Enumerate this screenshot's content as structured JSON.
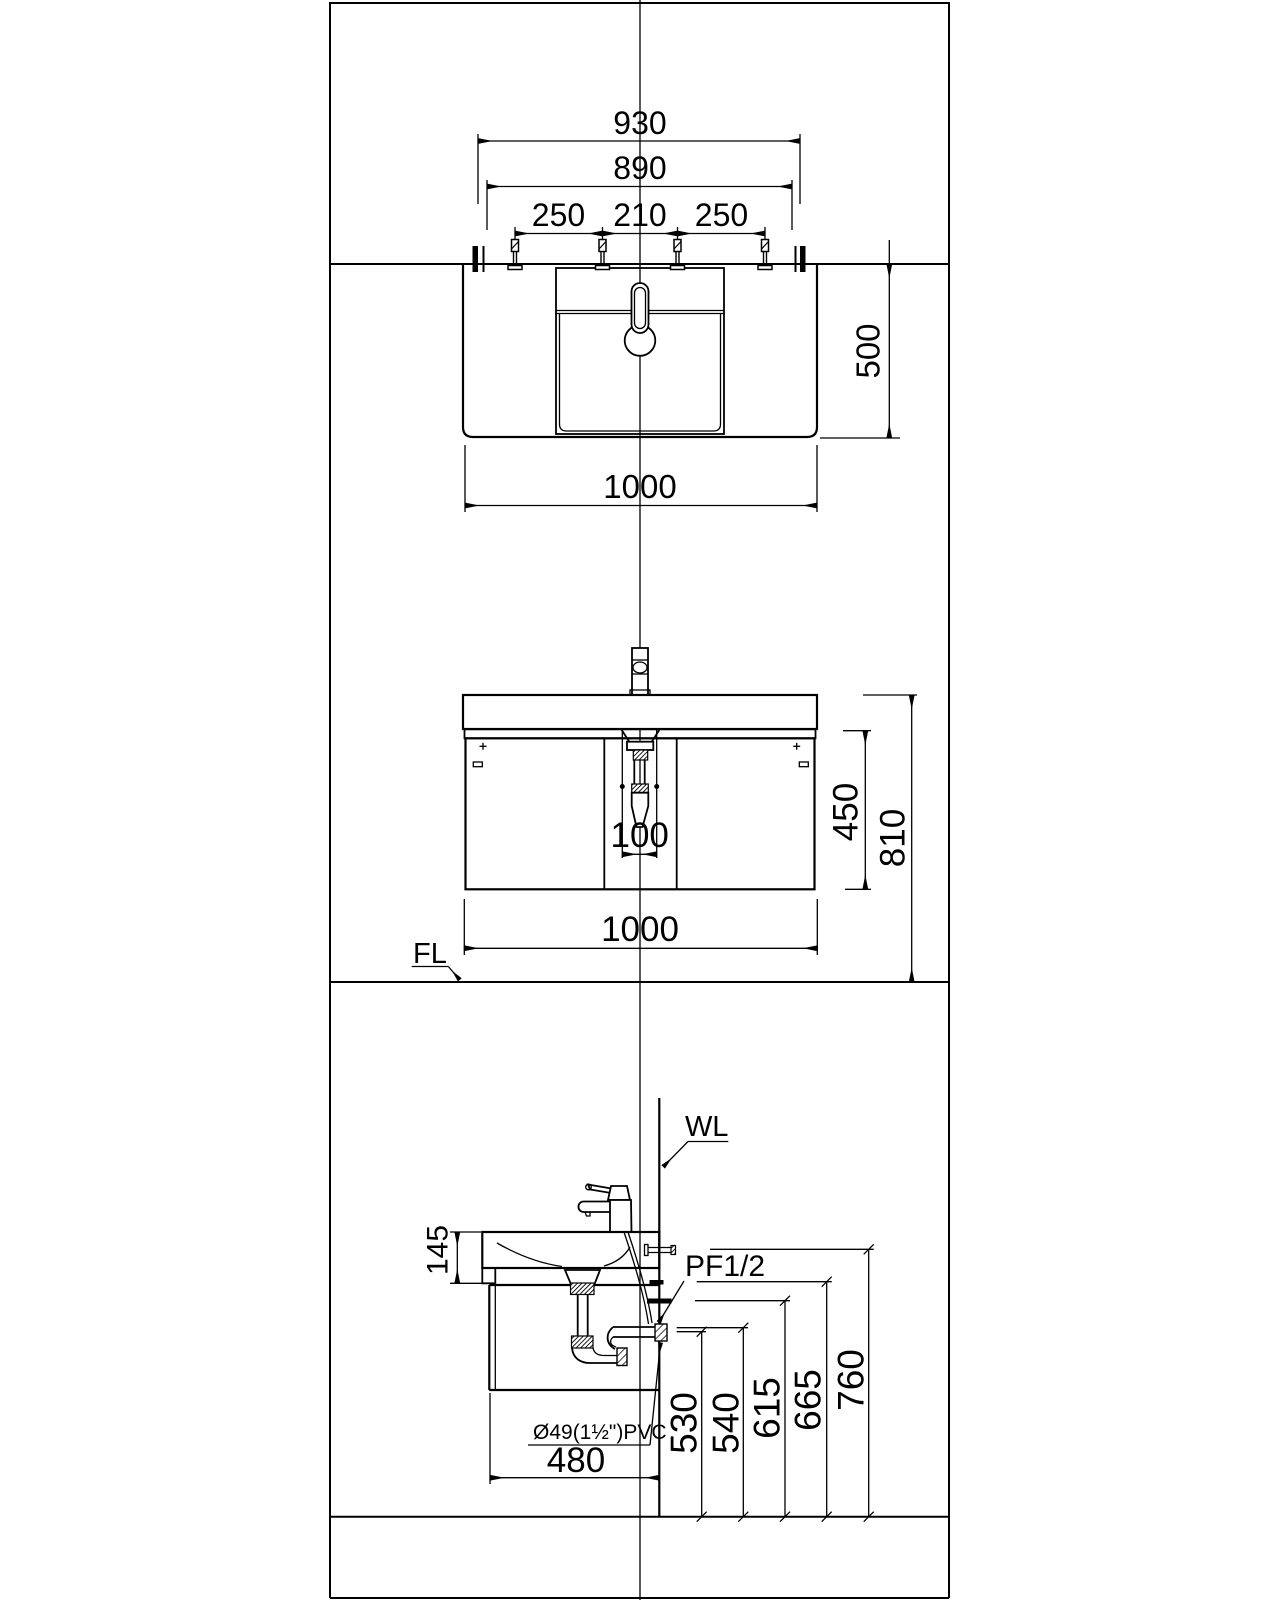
{
  "meta": {
    "drawing_type": "vanity cabinet installation drawing",
    "colors": {
      "line": "#000000",
      "background": "#ffffff"
    }
  },
  "plan": {
    "dim_overall": "930",
    "dim_inner": "890",
    "dim_bolt_left": "250",
    "dim_bolt_center": "210",
    "dim_bolt_right": "250",
    "dim_depth": "500",
    "dim_width": "1000"
  },
  "front": {
    "dim_drain_offset": "100",
    "dim_cabinet_height": "450",
    "dim_total_height": "810",
    "dim_width": "1000",
    "label_floor": "FL"
  },
  "side": {
    "dim_basin_front": "145",
    "dim_depth": "480",
    "dim_h1": "530",
    "dim_h2": "540",
    "dim_h3": "615",
    "dim_h4": "665",
    "dim_h5": "760",
    "label_wall": "WL",
    "label_supply": "PF1/2",
    "label_waste": "Ø49(1½\")PVC"
  }
}
